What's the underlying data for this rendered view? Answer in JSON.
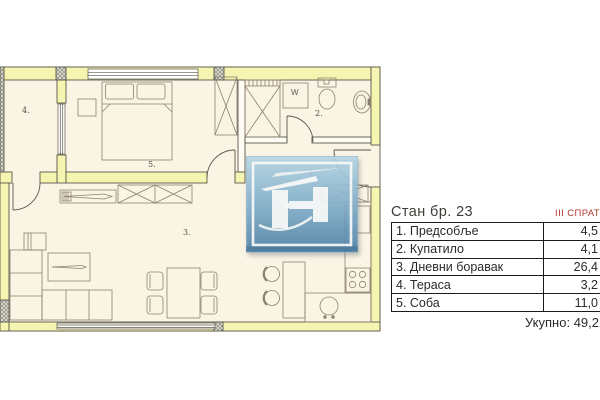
{
  "panel": {
    "title": "Стан бр. 23",
    "floor": "III СПРАТ",
    "rows": [
      {
        "label": "1. Предсобље",
        "area": "4,5"
      },
      {
        "label": "2. Купатило",
        "area": "4,1"
      },
      {
        "label": "3. Дневни боравак",
        "area": "26,4"
      },
      {
        "label": "4. Тераса",
        "area": "3,2"
      },
      {
        "label": "5. Соба",
        "area": "11,0"
      }
    ],
    "total_label": "Укупно:",
    "total_value": "49,2"
  },
  "plan": {
    "room_labels": {
      "hallway": "1.",
      "bathroom": "2.",
      "living": "3.",
      "terrace": "4.",
      "bedroom": "5."
    },
    "appliances": {
      "washer": "W",
      "fridge": "F"
    }
  },
  "colors": {
    "wall_fill": "#f5f4b0",
    "wall_outline": "#5a594c",
    "room_fill": "#faf4e4",
    "furniture_line": "#8d8070",
    "column_hatch": "#84837a",
    "floor_badge_red": "#b23a2e",
    "table_border": "#1b1b1b",
    "logo_gradient_top": "#b7d8e9",
    "logo_gradient_bottom": "#4e81a8"
  }
}
